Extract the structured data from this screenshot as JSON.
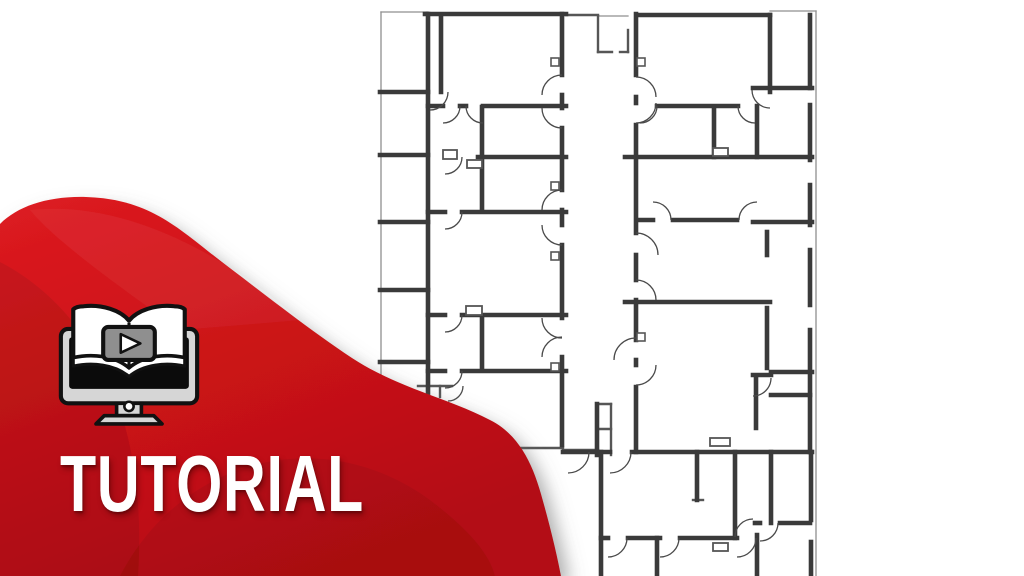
{
  "meta": {
    "kind": "video tutorial thumbnail",
    "subject": "architectural floor plan drawing"
  },
  "banner": {
    "title": "TUTORIAL",
    "icon": "book-play-monitor",
    "colors": {
      "red_bright": "#dd1b21",
      "red_main": "#c91217",
      "red_deep": "#ad0d12",
      "text": "#ffffff",
      "icon_outline": "#111111",
      "icon_gray": "#d6d6d6",
      "icon_screen": "#0b0b0b",
      "icon_play_bg": "#8f8f8f"
    }
  },
  "blob": {
    "path": "M 0,224 C 18,206 48,196 86,197 C 150,199 178,228 222,262 C 272,300 310,330 352,358 C 398,388 448,398 490,420 C 518,434 532,462 541,494 C 549,522 556,550 561,576 L 0,576 Z",
    "swirls": [
      {
        "path": "M 0,262 C 70,298 150,390 138,576 L 0,576 Z",
        "fill": "rgba(0,0,0,0.08)"
      },
      {
        "path": "M 120,576 C 180,460 320,420 430,500 C 470,530 490,555 495,576 Z",
        "fill": "rgba(0,0,0,0.06)"
      },
      {
        "path": "M 30,210 C 120,200 220,250 300,320 L 180,330 C 110,280 55,240 30,210 Z",
        "fill": "rgba(255,255,255,0.05)"
      }
    ]
  },
  "floorplan": {
    "stroke_thick": "#3a3a3a",
    "stroke_medium": "#565656",
    "stroke_thin": "#8f8f8f",
    "arc_color": "#4a4a4a",
    "walls_thick": [
      [
        425,
        14,
        566,
        14
      ],
      [
        428,
        14,
        428,
        452
      ],
      [
        380,
        92,
        428,
        92
      ],
      [
        380,
        155,
        428,
        155
      ],
      [
        380,
        222,
        428,
        222
      ],
      [
        380,
        290,
        428,
        290
      ],
      [
        380,
        362,
        428,
        362
      ],
      [
        383,
        448,
        428,
        448
      ],
      [
        441,
        16,
        441,
        92
      ],
      [
        428,
        106,
        443,
        106
      ],
      [
        460,
        106,
        466,
        106
      ],
      [
        483,
        106,
        566,
        106
      ],
      [
        482,
        107,
        482,
        210
      ],
      [
        478,
        157,
        566,
        157
      ],
      [
        428,
        212,
        445,
        212
      ],
      [
        462,
        212,
        566,
        212
      ],
      [
        428,
        315,
        445,
        315
      ],
      [
        462,
        315,
        566,
        315
      ],
      [
        482,
        317,
        482,
        367
      ],
      [
        428,
        371,
        445,
        371
      ],
      [
        462,
        371,
        566,
        371
      ],
      [
        562,
        14,
        562,
        75
      ],
      [
        562,
        95,
        562,
        108
      ],
      [
        562,
        128,
        562,
        190
      ],
      [
        562,
        210,
        562,
        225
      ],
      [
        562,
        245,
        562,
        318
      ],
      [
        562,
        357,
        562,
        445
      ],
      [
        636,
        14,
        636,
        75
      ],
      [
        636,
        97,
        636,
        103
      ],
      [
        636,
        125,
        636,
        233
      ],
      [
        636,
        255,
        636,
        280
      ],
      [
        636,
        300,
        636,
        340
      ],
      [
        636,
        360,
        636,
        365
      ],
      [
        636,
        387,
        636,
        452
      ],
      [
        637,
        15,
        770,
        15
      ],
      [
        770,
        15,
        770,
        92
      ],
      [
        753,
        88,
        812,
        88
      ],
      [
        757,
        106,
        757,
        157
      ],
      [
        657,
        106,
        738,
        106
      ],
      [
        714,
        108,
        714,
        157
      ],
      [
        625,
        157,
        812,
        157
      ],
      [
        637,
        220,
        653,
        220
      ],
      [
        673,
        220,
        737,
        220
      ],
      [
        753,
        222,
        812,
        222
      ],
      [
        767,
        232,
        767,
        255
      ],
      [
        625,
        302,
        770,
        302
      ],
      [
        767,
        308,
        767,
        368
      ],
      [
        753,
        375,
        771,
        375
      ],
      [
        756,
        378,
        756,
        428
      ],
      [
        771,
        372,
        812,
        372
      ],
      [
        771,
        395,
        810,
        395
      ],
      [
        810,
        15,
        810,
        88
      ],
      [
        810,
        105,
        810,
        160
      ],
      [
        810,
        185,
        810,
        225
      ],
      [
        810,
        250,
        810,
        305
      ],
      [
        810,
        330,
        810,
        452
      ],
      [
        811,
        452,
        811,
        520
      ],
      [
        811,
        542,
        811,
        576
      ],
      [
        563,
        452,
        610,
        452
      ],
      [
        632,
        452,
        812,
        452
      ],
      [
        601,
        452,
        601,
        576
      ],
      [
        697,
        452,
        697,
        500
      ],
      [
        735,
        452,
        735,
        538
      ],
      [
        771,
        452,
        771,
        523
      ],
      [
        601,
        538,
        608,
        538
      ],
      [
        628,
        538,
        660,
        538
      ],
      [
        680,
        538,
        737,
        538
      ],
      [
        657,
        538,
        657,
        576
      ],
      [
        757,
        535,
        757,
        576
      ],
      [
        755,
        523,
        760,
        523
      ],
      [
        780,
        523,
        810,
        523
      ],
      [
        597,
        404,
        597,
        455
      ]
    ],
    "walls_medium": [
      [
        611,
        404,
        611,
        455
      ],
      [
        597,
        404,
        611,
        404
      ],
      [
        597,
        429,
        611,
        429
      ],
      [
        598,
        16,
        598,
        52
      ],
      [
        598,
        52,
        612,
        52
      ],
      [
        620,
        52,
        628,
        52
      ],
      [
        628,
        30,
        628,
        52
      ],
      [
        505,
        448,
        563,
        448
      ],
      [
        563,
        450,
        598,
        450
      ],
      [
        693,
        500,
        703,
        500
      ],
      [
        418,
        386,
        452,
        386
      ],
      [
        440,
        386,
        440,
        397
      ],
      [
        566,
        15,
        598,
        15
      ]
    ],
    "walls_thin": [
      [
        381,
        12,
        381,
        450
      ],
      [
        816,
        11,
        816,
        576
      ],
      [
        770,
        11,
        816,
        11
      ],
      [
        598,
        16,
        628,
        16
      ],
      [
        381,
        12,
        428,
        12
      ]
    ],
    "window_squares": [
      [
        551,
        58
      ],
      [
        637,
        58
      ],
      [
        551,
        182
      ],
      [
        551,
        252
      ],
      [
        551,
        363
      ],
      [
        637,
        333
      ]
    ],
    "small_rects": [
      [
        443,
        150,
        14,
        9
      ],
      [
        467,
        160,
        15,
        8
      ],
      [
        466,
        306,
        16,
        9
      ],
      [
        713,
        148,
        15,
        8
      ],
      [
        710,
        438,
        20,
        8
      ],
      [
        713,
        543,
        15,
        8
      ]
    ],
    "door_arcs": [
      [
        562,
        95,
        20,
        "NW"
      ],
      [
        562,
        108,
        20,
        "SW"
      ],
      [
        562,
        210,
        20,
        "NW"
      ],
      [
        562,
        225,
        20,
        "SW"
      ],
      [
        562,
        318,
        20,
        "SW"
      ],
      [
        562,
        357,
        20,
        "NW"
      ],
      [
        636,
        97,
        20,
        "NE"
      ],
      [
        636,
        103,
        20,
        "SE"
      ],
      [
        636,
        255,
        22,
        "NE"
      ],
      [
        636,
        300,
        20,
        "NE"
      ],
      [
        636,
        360,
        22,
        "NW"
      ],
      [
        636,
        365,
        20,
        "SE"
      ],
      [
        430,
        92,
        18,
        "SE"
      ],
      [
        443,
        106,
        17,
        "SE"
      ],
      [
        483,
        106,
        17,
        "SW"
      ],
      [
        445,
        157,
        17,
        "SE"
      ],
      [
        445,
        212,
        17,
        "SE"
      ],
      [
        445,
        315,
        17,
        "SE"
      ],
      [
        445,
        371,
        17,
        "SE"
      ],
      [
        448,
        386,
        15,
        "SE"
      ],
      [
        640,
        106,
        17,
        "SE"
      ],
      [
        755,
        106,
        17,
        "SW"
      ],
      [
        770,
        90,
        18,
        "SW"
      ],
      [
        653,
        220,
        18,
        "NE"
      ],
      [
        757,
        220,
        18,
        "NW"
      ],
      [
        753,
        378,
        18,
        "SE"
      ],
      [
        610,
        452,
        21,
        "SE"
      ],
      [
        568,
        452,
        21,
        "SE"
      ],
      [
        760,
        523,
        18,
        "SE"
      ],
      [
        753,
        537,
        18,
        "NW"
      ],
      [
        608,
        538,
        19,
        "SE"
      ],
      [
        660,
        538,
        19,
        "SE"
      ],
      [
        737,
        538,
        19,
        "SE"
      ]
    ]
  }
}
